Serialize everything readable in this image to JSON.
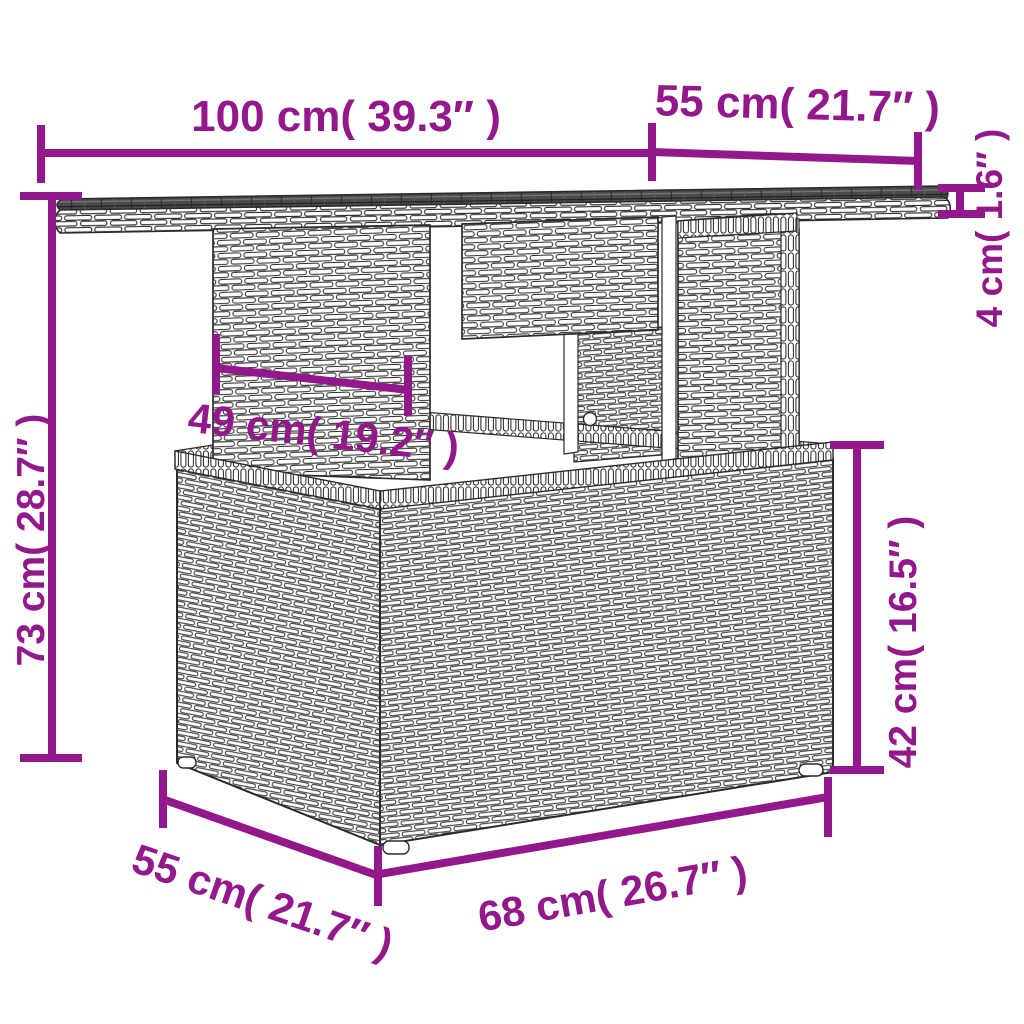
{
  "diagram": {
    "kind": "product-dimension-diagram",
    "accent_color": "#93188B",
    "line_color": "#2b2b2b",
    "background_color": "#ffffff"
  },
  "dimensions": {
    "top_width": {
      "label": "100 cm( 39.3″ )"
    },
    "top_depth": {
      "label": "55 cm( 21.7″ )"
    },
    "top_thickness": {
      "label": "4 cm( 1.6″ )"
    },
    "overall_height": {
      "label": "73 cm( 28.7″ )"
    },
    "pedestal_width": {
      "label": "49 cm( 19.2″ )"
    },
    "base_height": {
      "label": "42 cm( 16.5″ )"
    },
    "base_width": {
      "label": "68 cm( 26.7″ )"
    },
    "base_depth": {
      "label": "55 cm( 21.7″ )"
    }
  }
}
